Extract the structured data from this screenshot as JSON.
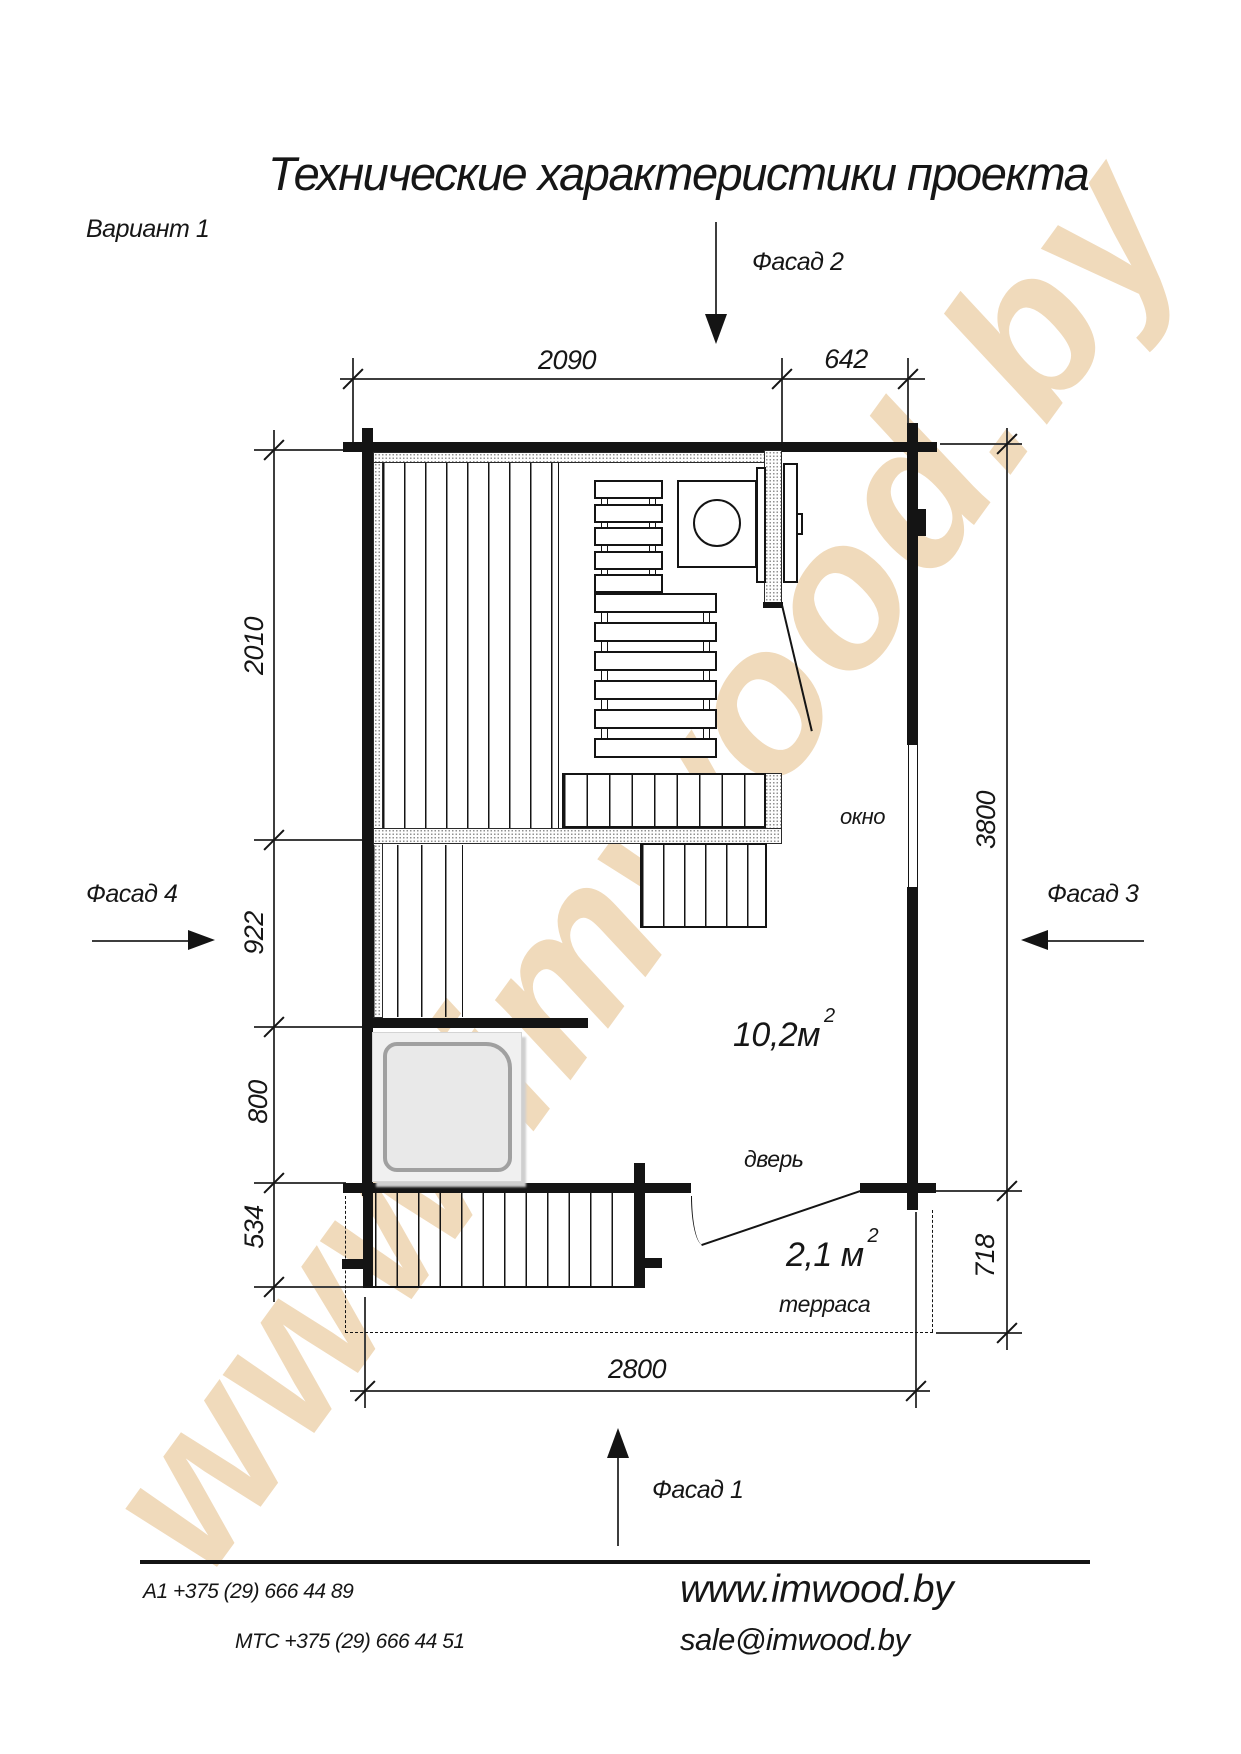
{
  "title": "Технические характеристики проекта",
  "variant": "Вариант 1",
  "watermark": "www.imwood.by",
  "facades": {
    "f1": "Фасад 1",
    "f2": "Фасад 2",
    "f3": "Фасад 3",
    "f4": "Фасад 4"
  },
  "dims": {
    "top_main": "2090",
    "top_right": "642",
    "left_sauna": "2010",
    "left_wash": "922",
    "left_hall": "800",
    "left_steps": "534",
    "right_total": "3800",
    "right_terrace": "718",
    "bottom_total": "2800"
  },
  "labels": {
    "window": "окно",
    "door": "дверь",
    "terrace": "терраса",
    "area_main": "10,2м",
    "area_main_sup": "2",
    "area_terrace": "2,1 м",
    "area_terrace_sup": "2"
  },
  "footer": {
    "phone_a1": "А1 +375 (29) 666 44 89",
    "phone_mts": "МТС +375 (29) 666 44 51",
    "site": "www.imwood.by",
    "email": "sale@imwood.by"
  }
}
